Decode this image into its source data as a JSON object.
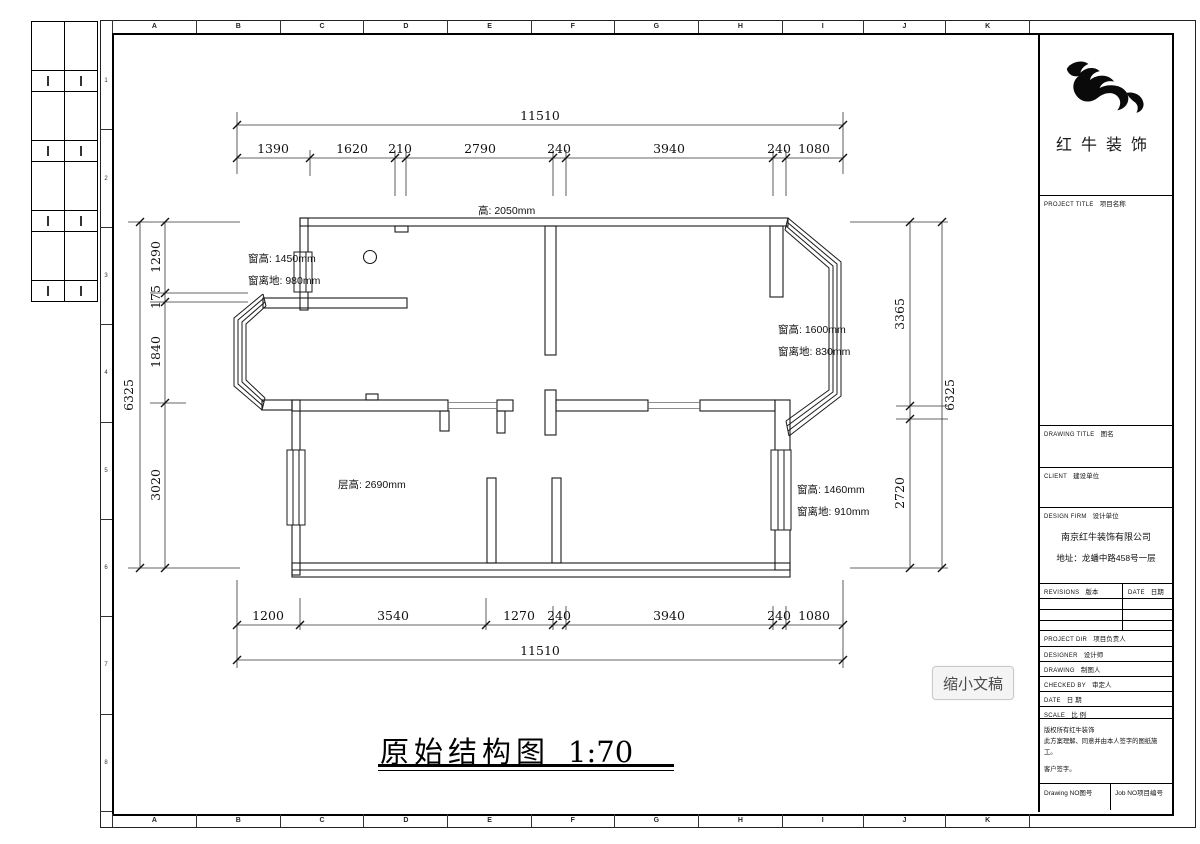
{
  "frame": {
    "letters": [
      "A",
      "B",
      "C",
      "D",
      "E",
      "F",
      "G",
      "H",
      "I",
      "J",
      "K"
    ],
    "numbers": [
      "1",
      "2",
      "3",
      "4",
      "5",
      "6",
      "7",
      "8"
    ]
  },
  "title_bar": {
    "text": "原始结构图",
    "scale": "1:70"
  },
  "overlay": {
    "label": "缩小文稿"
  },
  "plan": {
    "annotations": {
      "beam_height": "高: 2050mm",
      "win_left_top_1": "窗高: 1450mm",
      "win_left_top_2": "窗离地: 980mm",
      "win_right_mid_1": "窗高: 1600mm",
      "win_right_mid_2": "窗离地: 830mm",
      "floor_height": "层高: 2690mm",
      "win_right_low_1": "窗高: 1460mm",
      "win_right_low_2": "窗离地: 910mm"
    },
    "dims": {
      "top_total": "11510",
      "top_segments": [
        "1390",
        "1620",
        "210",
        "2790",
        "240",
        "3940",
        "240",
        "1080"
      ],
      "bottom_segments": [
        "1200",
        "3540",
        "1270",
        "240",
        "3940",
        "240",
        "1080"
      ],
      "bottom_total": "11510",
      "left_total": "6325",
      "left_segments": [
        "1290",
        "175",
        "1840",
        "3020"
      ],
      "right_segments": [
        "3365",
        "2720"
      ],
      "right_total": "6325"
    }
  },
  "titleblock": {
    "brand": "红牛装饰",
    "project_title": {
      "en": "PROJECT TITLE",
      "zh": "项目名称"
    },
    "drawing_title": {
      "en": "DRAWING TITLE",
      "zh": "图名"
    },
    "client": {
      "en": "CLIENT",
      "zh": "建设单位"
    },
    "design_firm": {
      "en": "DESIGN FIRM",
      "zh": "设计单位"
    },
    "company": "南京红牛装饰有限公司",
    "address": "地址：龙蟠中路458号一层",
    "revisions": {
      "en": "REVISIONS",
      "zh": "版本"
    },
    "date_col": {
      "en": "DATE",
      "zh": "日期"
    },
    "rows": [
      {
        "en": "PROJECT DIR",
        "zh": "项目负责人"
      },
      {
        "en": "DESIGNER",
        "zh": "设计师"
      },
      {
        "en": "DRAWING",
        "zh": "制图人"
      },
      {
        "en": "CHECKED BY",
        "zh": "审定人"
      },
      {
        "en": "DATE",
        "zh": "日 期"
      },
      {
        "en": "SCALE",
        "zh": "比 例"
      }
    ],
    "copyright_lines": [
      "版权所有红牛装饰",
      "此方案理解、同意并由本人签字的图纸施工。",
      "客户签字。"
    ],
    "drawing_no": {
      "en": "Drawing NO",
      "zh": "图号"
    },
    "job_no": {
      "en": "Job NO",
      "zh": "项目编号"
    }
  }
}
